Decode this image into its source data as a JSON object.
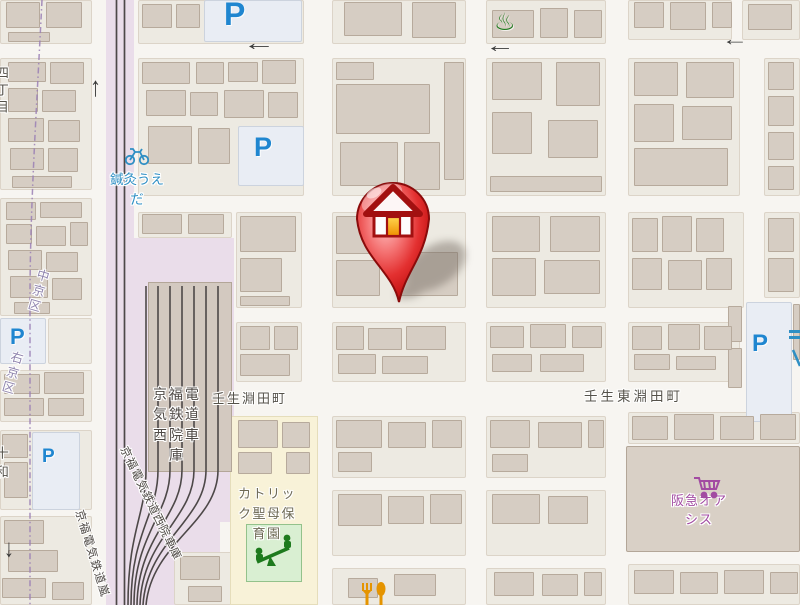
{
  "map_type": "street-map",
  "labels": {
    "town_left": "壬生淵田町",
    "town_right": "壬生東淵田町",
    "depot_block": "京福電気鉄道西院車庫",
    "depot_diagonal": "京福電気鉄道西院車庫",
    "railline_diagonal_clipped": "京福電気鉄道嵐",
    "ward_nakagyo": "中京区",
    "ward_ukyo": "右京区",
    "nursery": "カトリック聖母保育園",
    "acupuncture_line1": "鍼灸うえ",
    "acupuncture_line2": "だ",
    "supermarket_line1": "阪急オア",
    "supermarket_line2": "シス",
    "left_edge_chome_clipped": "四丁目",
    "left_edge_clipped": "十和"
  },
  "glyphs": {
    "parking": "P",
    "arrow_left": "←",
    "arrow_up": "↑",
    "arrow_down": "↓",
    "onsen": "♨"
  },
  "icons": [
    "red-house-map-pin",
    "parking-icon",
    "bicycle-icon",
    "onsen-icon",
    "shopping-cart-icon",
    "fork-spoon-icon",
    "playground-icon",
    "one-way-arrow-icon"
  ],
  "colors": {
    "parking_blue": "#1f86d0",
    "poi_blue": "#2f8fc4",
    "poi_purple": "#a24ba2",
    "poi_green": "#1d7a1d",
    "poi_orange": "#e59400",
    "ward_boundary_purple": "#9a7fb5",
    "marker_red": "#d42a2a",
    "railway_band": "#eaddea",
    "rail_line": "#4d4848",
    "building_fill": "#d6cdc3",
    "block_fill": "#edeae2",
    "street_white": "#f7f5f1",
    "nursery_yellow": "#f8f2d8",
    "park_green": "#d9efd2"
  }
}
